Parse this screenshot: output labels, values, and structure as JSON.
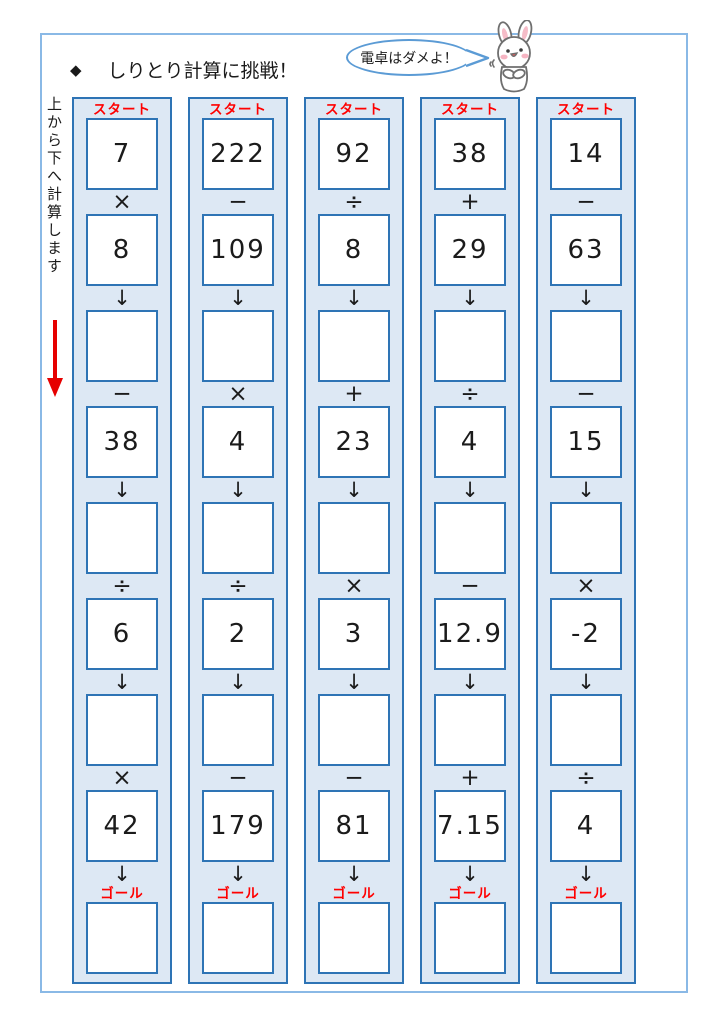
{
  "header": {
    "diamond": "◆",
    "title": "しりとり計算に挑戦！",
    "bubble_text": "電卓はダメよ！"
  },
  "side": {
    "instruction": "上から下へ計算します"
  },
  "labels": {
    "start": "スタート",
    "goal": "ゴール",
    "arrow": "↓"
  },
  "columns": [
    {
      "start_value": "7",
      "steps": [
        {
          "op": "×",
          "value": "8"
        },
        {
          "op": "−",
          "value": "38"
        },
        {
          "op": "÷",
          "value": "6"
        },
        {
          "op": "×",
          "value": "42"
        }
      ]
    },
    {
      "start_value": "222",
      "steps": [
        {
          "op": "−",
          "value": "109"
        },
        {
          "op": "×",
          "value": "4"
        },
        {
          "op": "÷",
          "value": "2"
        },
        {
          "op": "−",
          "value": "179"
        }
      ]
    },
    {
      "start_value": "92",
      "steps": [
        {
          "op": "÷",
          "value": "8"
        },
        {
          "op": "+",
          "value": "23"
        },
        {
          "op": "×",
          "value": "3"
        },
        {
          "op": "−",
          "value": "81"
        }
      ]
    },
    {
      "start_value": "38",
      "steps": [
        {
          "op": "+",
          "value": "29"
        },
        {
          "op": "÷",
          "value": "4"
        },
        {
          "op": "−",
          "value": "12.9"
        },
        {
          "op": "+",
          "value": "7.15"
        }
      ]
    },
    {
      "start_value": "14",
      "steps": [
        {
          "op": "−",
          "value": "63"
        },
        {
          "op": "−",
          "value": "15"
        },
        {
          "op": "×",
          "value": "-2"
        },
        {
          "op": "÷",
          "value": "4"
        }
      ]
    }
  ],
  "colors": {
    "accent_red": "#ff0000",
    "column_bg": "#dde8f4",
    "column_border": "#2e74b5",
    "frame_border": "#8ab9e6",
    "bubble_border": "#5b9bd5"
  }
}
